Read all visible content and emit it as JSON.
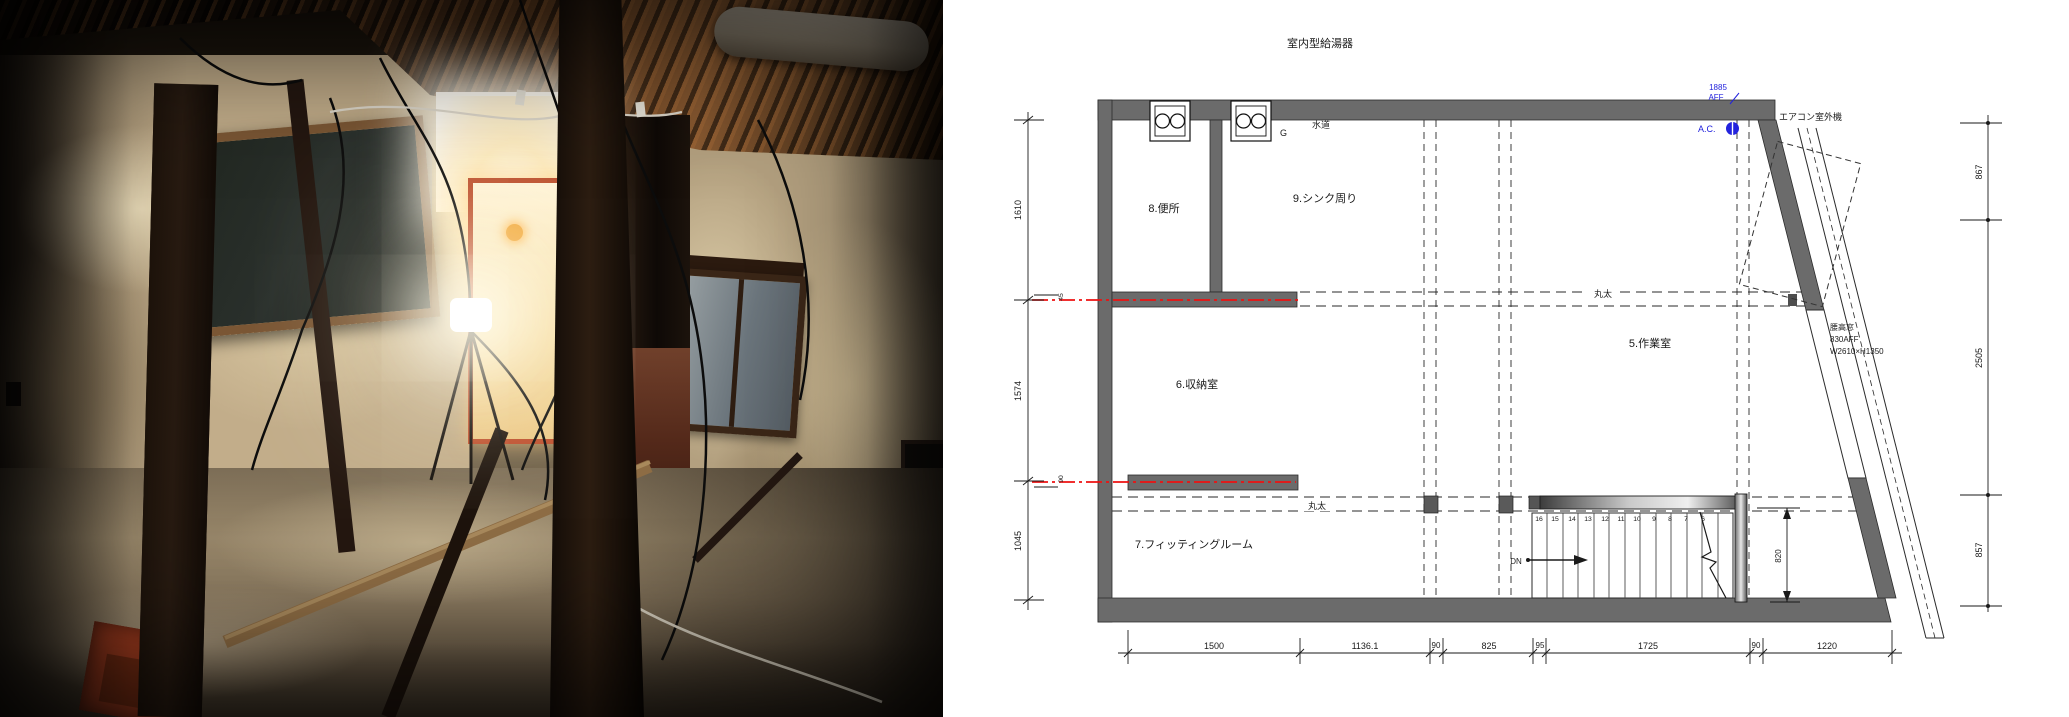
{
  "palette": {
    "wall_gray": "#6b6b6b",
    "annotation_blue": "#2323dd",
    "marker_red": "#ee1212",
    "line_black": "#1a1a1a",
    "paper_white": "#ffffff"
  },
  "plan": {
    "title": "室内型給湯器",
    "rooms": {
      "toilet": "8.便所",
      "sink": "9.シンク周り",
      "storage": "6.収納室",
      "work": "5.作業室",
      "fitting": "7.フィッティングルーム",
      "stairwell": "4.階段室"
    },
    "labels": {
      "water": "水道",
      "gas": "G",
      "log": "丸太",
      "ac_outdoor": "エアコン室外機",
      "ac": "A.C.",
      "aff_value": "1885",
      "aff": "AFF",
      "dn": "DN",
      "window_line1": "腰高窓",
      "window_line2": "830AFF",
      "window_line3": "W2610×H1350"
    },
    "dims": {
      "left": [
        "1610",
        "1574",
        "1045"
      ],
      "right": [
        "867",
        "2505",
        "857"
      ],
      "bottom": [
        "1500",
        "1136.1",
        "90",
        "825",
        "95",
        "1725",
        "90",
        "1220"
      ],
      "stair": "820",
      "small_upper": "45",
      "small_lower": "90"
    },
    "stair_steps": [
      "16",
      "15",
      "14",
      "13",
      "12",
      "11",
      "10",
      "9",
      "8",
      "7",
      "6"
    ]
  }
}
